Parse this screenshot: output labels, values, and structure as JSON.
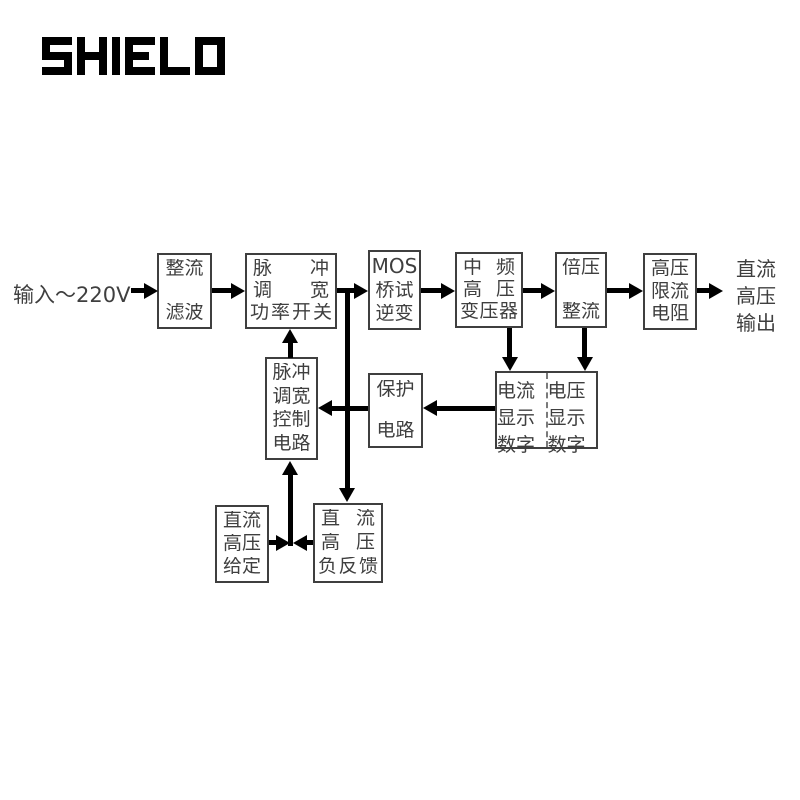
{
  "logo": {
    "text": "SHIELD"
  },
  "colors": {
    "background": "#ffffff",
    "connector_line": "#000000",
    "box_border": "#3f3f3f",
    "text": "#3f3f3f",
    "logo": "#000000"
  },
  "diagram": {
    "input_label": "输入～220V",
    "output_label": {
      "lines": [
        "直流",
        "高压",
        "输出"
      ]
    },
    "boxes": {
      "rectifier_filter": {
        "lines": [
          "整流",
          "滤波"
        ]
      },
      "pwm_power_switch": {
        "lines": [
          "脉 冲",
          "调 宽",
          "功率开关"
        ]
      },
      "mos_bridge_inverter": {
        "lines": [
          "MOS",
          "桥试",
          "逆变"
        ]
      },
      "mf_hv_transformer": {
        "lines": [
          "中 频",
          "高 压",
          "变压器"
        ]
      },
      "voltage_doubler_rectifier": {
        "lines": [
          "倍压",
          "整流"
        ]
      },
      "hv_current_limit_resistor": {
        "lines": [
          "高压",
          "限流",
          "电阻"
        ]
      },
      "pwm_control_circuit": {
        "lines": [
          "脉冲",
          "调宽",
          "控制",
          "电路"
        ]
      },
      "protection_circuit": {
        "lines": [
          "保护",
          "电路"
        ]
      },
      "current_display": {
        "lines": [
          "电流",
          "显示",
          "数字"
        ]
      },
      "voltage_display": {
        "lines": [
          "电压",
          "显示",
          "数字"
        ]
      },
      "dc_hv_setpoint": {
        "lines": [
          "直流",
          "高压",
          "给定"
        ]
      },
      "dc_hv_negative_feedback": {
        "lines": [
          "直 流",
          "高 压",
          "负反馈"
        ]
      }
    }
  }
}
